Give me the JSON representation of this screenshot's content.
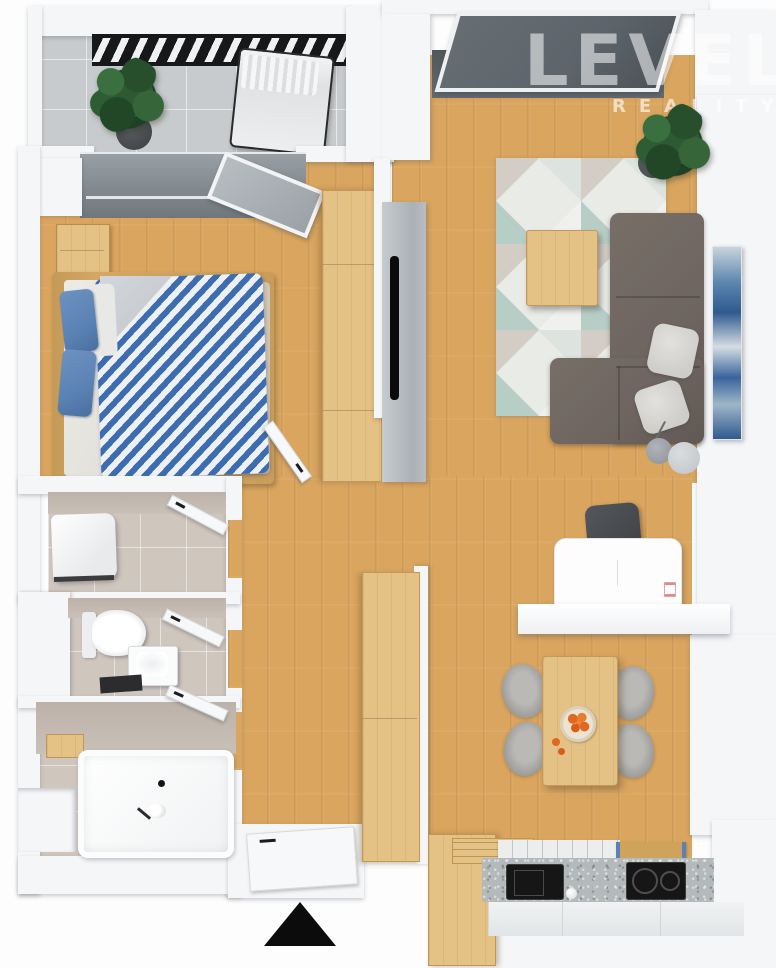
{
  "watermark": {
    "title": "LEVEL",
    "subtitle": "REALITY"
  },
  "colors": {
    "wall": "#f5f6f8",
    "wood": "#d9a55f",
    "wood_light": "#e4c184",
    "tile_gray": "#c8cbcd",
    "tile_beige": "#cfc6be",
    "glass": "#5d646b",
    "railing": "#17181a",
    "sofa": "#6e6560",
    "rug_teal": "#b7cec7",
    "rug_gray": "#d3cdc6",
    "duvet_blue": "#3e6cb0",
    "pillow_blue": "#5b82b4",
    "counter": "#b4babc",
    "appliance_black": "#161616",
    "chair": "#9b9b99",
    "accent_orange": "#e2671f",
    "art_blue": "#39649c",
    "foliage": "#2d5a33",
    "north_arrow": "#0c0c0c"
  },
  "objects": {
    "compass": "north-arrow",
    "rooms": [
      "balcony",
      "bedroom",
      "living-room",
      "hallway",
      "laundry",
      "wc",
      "bathroom",
      "dining-area",
      "kitchen"
    ],
    "furniture": [
      "double-bed",
      "nightstand",
      "wardrobe",
      "tv-panel",
      "corner-sofa",
      "coffee-table",
      "rug",
      "floor-lamp",
      "wall-art",
      "desk",
      "desk-chair",
      "dining-table",
      "dining-chair",
      "fruit-bowl",
      "kitchen-counter",
      "sink",
      "cooktop",
      "washing-machine",
      "toilet",
      "washbasin",
      "bathtub",
      "lounge-chair",
      "potted-plant"
    ]
  }
}
